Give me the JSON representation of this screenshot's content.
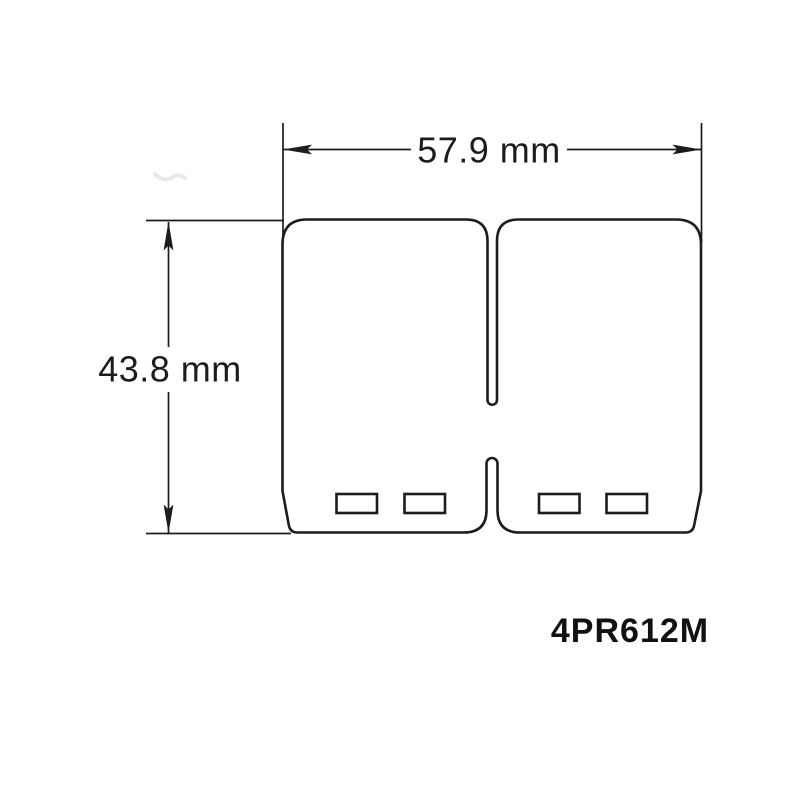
{
  "page": {
    "background_color": "#ffffff"
  },
  "diagram": {
    "kind": "reed-petal-technical-drawing",
    "line_color": "#1c1c1c",
    "part_number": "4PR612M",
    "width_dimension": {
      "label": "57.9 mm",
      "value_mm": 57.9
    },
    "height_dimension": {
      "label": "43.8 mm",
      "value_mm": 43.8
    }
  }
}
